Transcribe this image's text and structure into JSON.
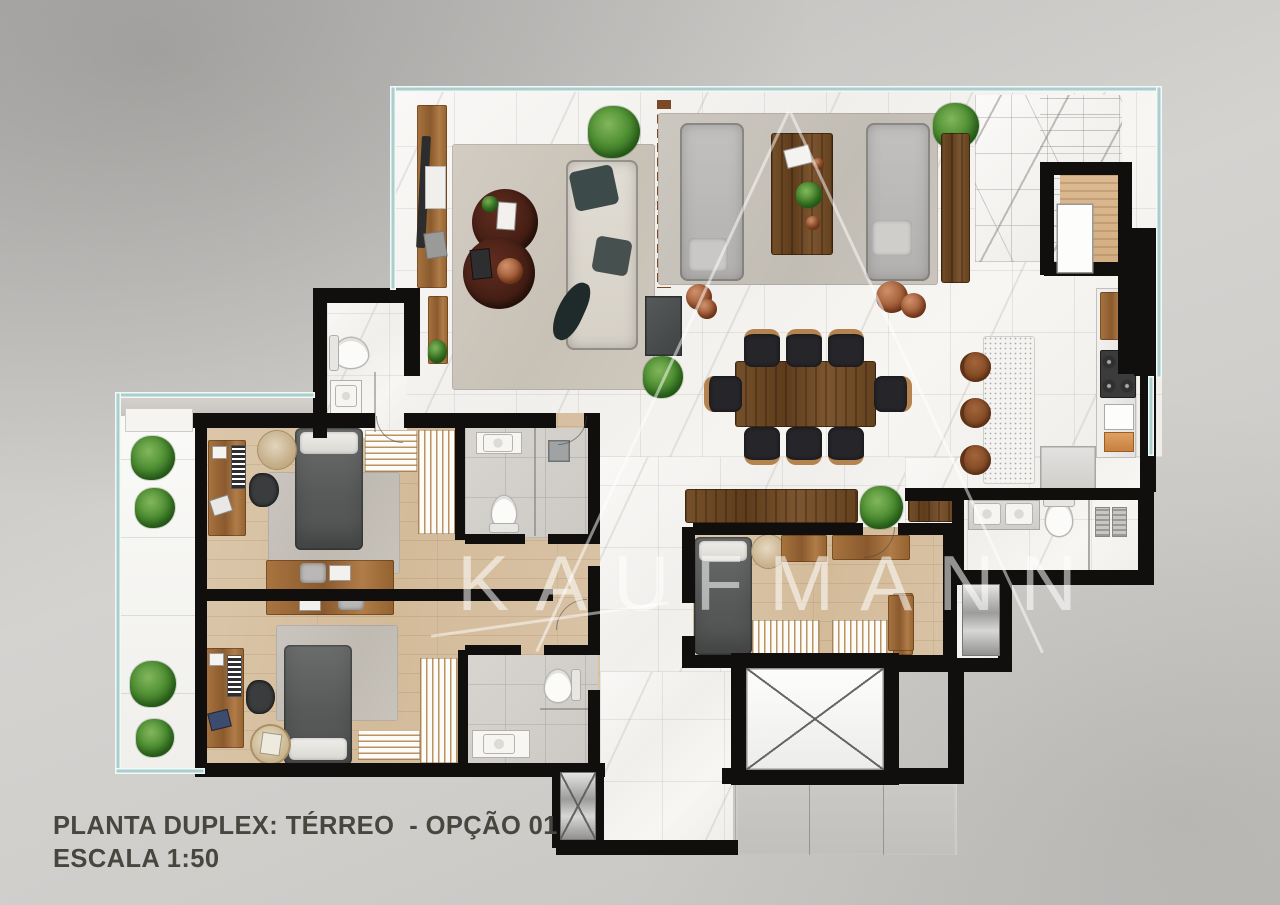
{
  "caption": {
    "line1": "PLANTA DUPLEX: TÉRREO  - OPÇÃO 01",
    "line2": "ESCALA 1:50"
  },
  "watermark": "KAUFMANN",
  "palette": {
    "background_gray": "#cfcdca",
    "wall_black": "#100f0d",
    "facade_glass_teal": "#a9cfcc",
    "marble_floor": "#f6f5f2",
    "wood_floor": "#d9c3a7",
    "furniture_wood": "#8a5a2e",
    "dining_table_wood": "#5e3c1e",
    "sofa_gray": "#b7b6b4",
    "sofa_beige": "#dcd7ce",
    "bed_duvet_gray": "#585a59",
    "plant_green": "#4f8f33",
    "terracotta_pot": "#9c5632",
    "concrete_common": "#c6c4c1",
    "stainless": "#b9b9b9",
    "caption_text": "#47473f",
    "watermark_white": "rgba(255,255,255,0.55)"
  }
}
